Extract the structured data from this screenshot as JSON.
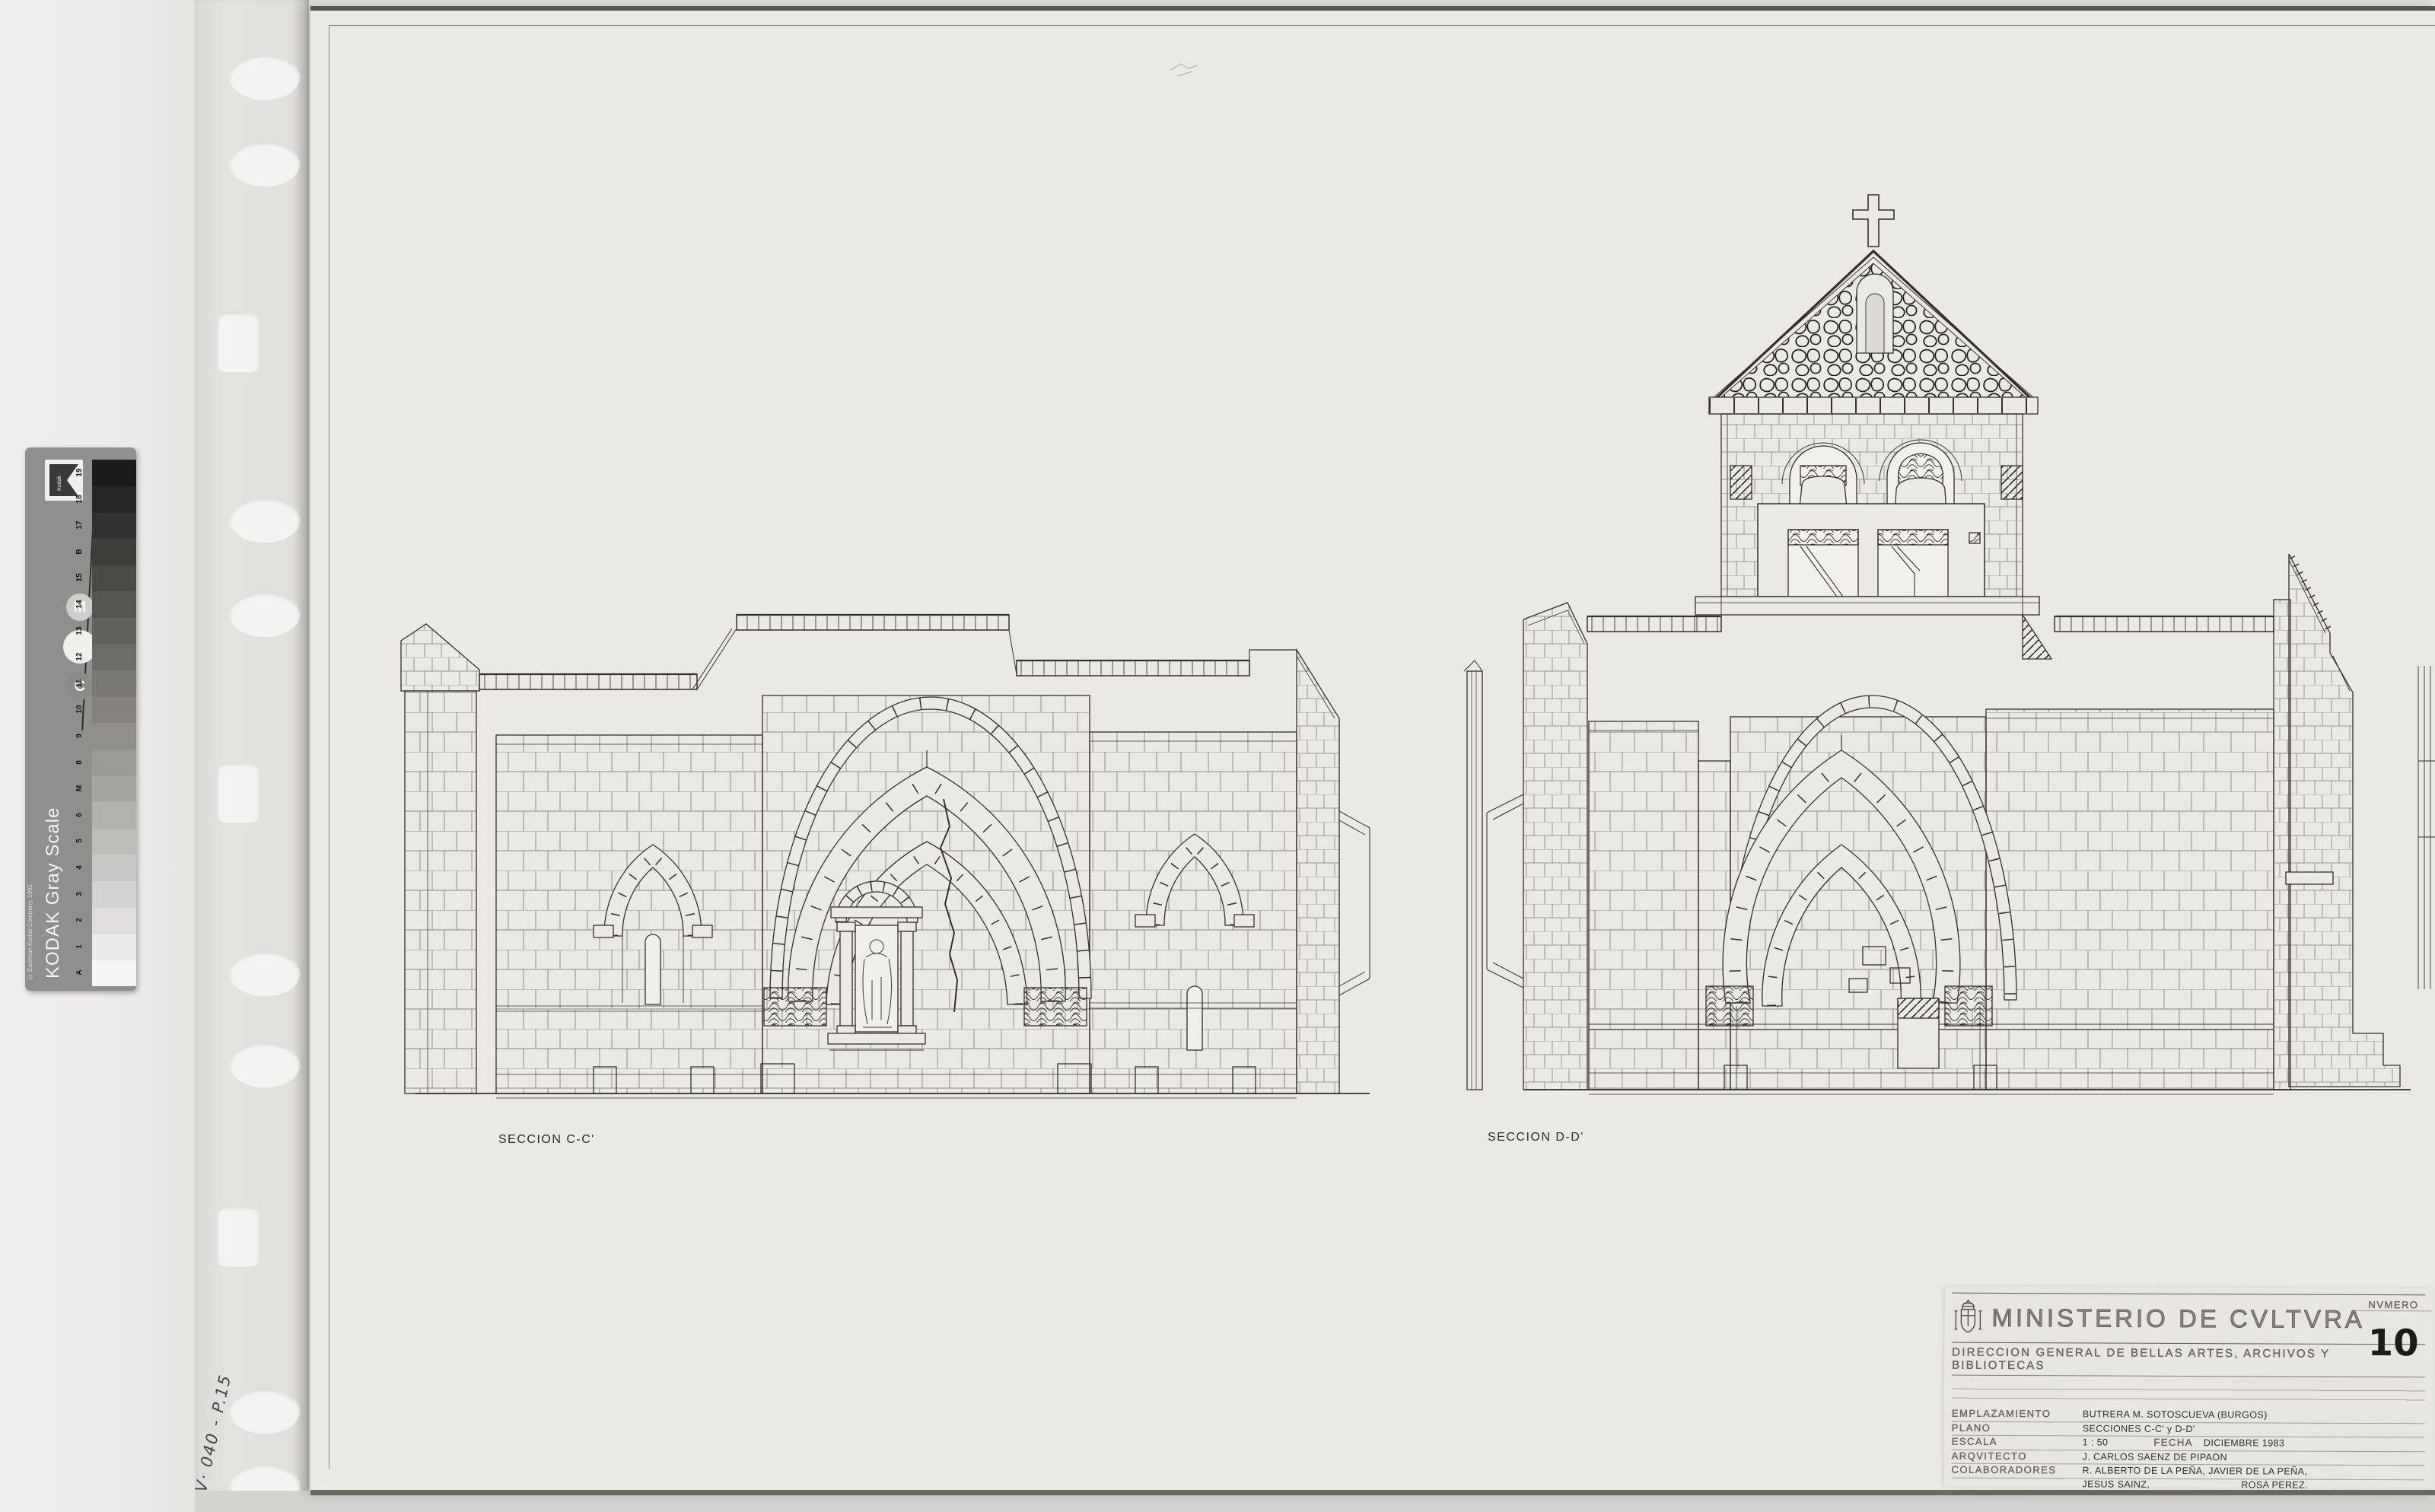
{
  "sheet": {
    "section_labels": [
      {
        "id": "cc",
        "text": "SECCION C-C'"
      },
      {
        "id": "dd",
        "text": "SECCION D-D'"
      }
    ],
    "handwritten_note": "V· 040 - P.15"
  },
  "title_block": {
    "ministry": "MINISTERIO DE CVLTVRA",
    "direction": "DIRECCION GENERAL DE BELLAS ARTES, ARCHIVOS Y BIBLIOTECAS",
    "fields": [
      {
        "label": "EMPLAZAMIENTO",
        "value": "BUTRERA   M. SOTOSCUEVA   (BURGOS)"
      },
      {
        "label": "PLANO",
        "value": "SECCIONES C-C' y D-D'"
      },
      {
        "label": "ESCALA",
        "value": "1 : 50",
        "label2": "FECHA",
        "value2": "DICIEMBRE 1983"
      },
      {
        "label": "ARQVITECTO",
        "value": "J. CARLOS SAENZ DE PIPAON"
      },
      {
        "label": "COLABORADORES",
        "value": "R. ALBERTO DE LA PEÑA,    JAVIER DE LA PEÑA,"
      },
      {
        "label": "",
        "value": "JESUS SAINZ,",
        "value2": "ROSA PEREZ."
      }
    ],
    "numero_label": "NVMERO",
    "numero_value": "10"
  },
  "kodak_strip": {
    "brand": "KODAK Gray Scale",
    "copyright": "© Eastman Kodak Company, 1995",
    "logo_text": "Kodak",
    "marker_letters": [
      "M",
      "",
      "C"
    ],
    "scale_labels": [
      "A",
      "1",
      "2",
      "3",
      "4",
      "5",
      "6",
      "M",
      "8",
      "9",
      "10",
      "11",
      "12",
      "13",
      "14",
      "15",
      "B",
      "17",
      "18",
      "19"
    ]
  },
  "colors": {
    "paper": "#eae9e6",
    "ink": "#33302c",
    "background": "#e0dfdc",
    "kodak_body": "#8f8f8d"
  }
}
